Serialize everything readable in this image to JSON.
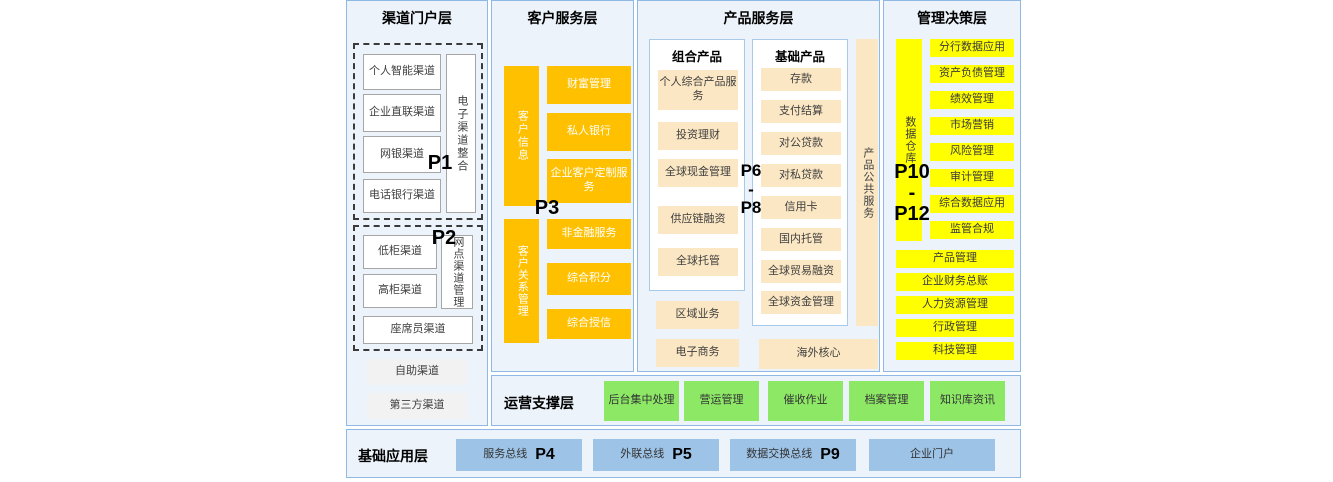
{
  "colors": {
    "panel_bg": "#ECF3FB",
    "panel_border": "#8FB9E4",
    "orange": "#FFC000",
    "cream": "#FBE7C3",
    "yellow": "#FFFF00",
    "green": "#8DE866",
    "blue": "#9DC3E6"
  },
  "channel_layer": {
    "title": "渠道门户层",
    "p1": "P1",
    "p2": "P2",
    "group1_items": [
      "个人智能渠道",
      "企业直联渠道",
      "网银渠道",
      "电话银行渠道"
    ],
    "group1_side": "电子渠道整合",
    "group2_items": [
      "低柜渠道",
      "高柜渠道"
    ],
    "group2_side": "网点渠道管理",
    "group2_bottom": "座席员渠道",
    "extra_items": [
      "自助渠道",
      "第三方渠道"
    ]
  },
  "customer_layer": {
    "title": "客户服务层",
    "p3": "P3",
    "bar_top": "客户信息",
    "bar_bottom": "客户关系管理",
    "top_items": [
      "财富管理",
      "私人银行",
      "企业客户定制服务"
    ],
    "bottom_items": [
      "非金融服务",
      "综合积分",
      "综合授信"
    ]
  },
  "product_layer": {
    "title": "产品服务层",
    "p_top": "P6",
    "p_dash": "-",
    "p_bottom": "P8",
    "combo_title": "组合产品",
    "combo_items": [
      "个人综合产品服务",
      "投资理财",
      "全球现金管理",
      "供应链融资",
      "全球托管"
    ],
    "basic_title": "基础产品",
    "basic_items": [
      "存款",
      "支付结算",
      "对公贷款",
      "对私贷款",
      "信用卡",
      "国内托管",
      "全球贸易融资",
      "全球资金管理"
    ],
    "public_bar": "产品公共服务",
    "left_extra_items": [
      "区域业务",
      "电子商务"
    ],
    "overseas": "海外核心"
  },
  "management_layer": {
    "title": "管理决策层",
    "p_top": "P10",
    "p_dash": "-",
    "p_bottom": "P12",
    "warehouse_bar": "数据仓库",
    "side_items": [
      "分行数据应用",
      "资产负债管理",
      "绩效管理",
      "市场营销",
      "风险管理",
      "审计管理",
      "综合数据应用",
      "监管合规"
    ],
    "wide_items": [
      "产品管理",
      "企业财务总账",
      "人力资源管理",
      "行政管理",
      "科技管理"
    ]
  },
  "operations_layer": {
    "title": "运营支撑层",
    "items": [
      "后台集中处理",
      "营运管理",
      "催收作业",
      "档案管理",
      "知识库资讯"
    ]
  },
  "foundation_layer": {
    "title": "基础应用层",
    "items": [
      {
        "label": "服务总线",
        "p": "P4"
      },
      {
        "label": "外联总线",
        "p": "P5"
      },
      {
        "label": "数据交换总线",
        "p": "P9"
      },
      {
        "label": "企业门户",
        "p": ""
      }
    ]
  }
}
